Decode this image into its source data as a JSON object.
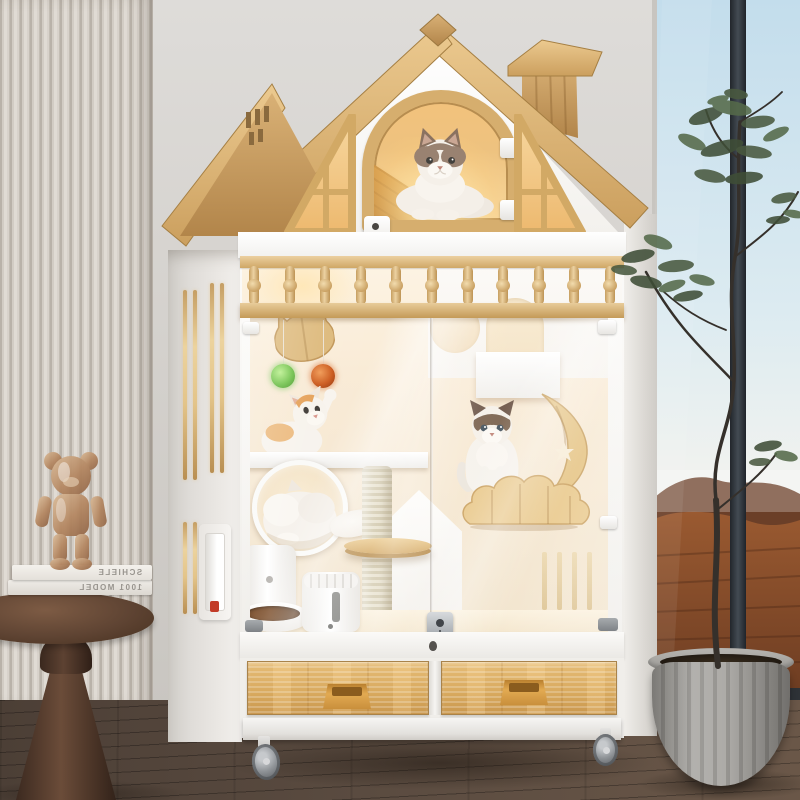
{
  "meta": {
    "type": "product-photo",
    "subject": "Wooden cat villa cage with cats, in a modern living room beside a floor window"
  },
  "decor": {
    "books": [
      {
        "title": "SCHIELE"
      },
      {
        "title": "1001 MODEL"
      }
    ]
  },
  "house": {
    "baluster_count": 11,
    "drawer_count": 2,
    "cat_count": 4,
    "pom_pom_colors": [
      "#5aa832",
      "#b84a16"
    ]
  },
  "palette": {
    "roof_wood": "#d2a868",
    "body_white": "#f7f6f3",
    "wall_gray": "#d5d2ce",
    "slat_wall": "#d7d1c9",
    "floor_wood": "#55473d",
    "window_frame": "#33383d",
    "sky": "#cfe3ee",
    "desert_ground": "#9a5a30",
    "drawer_wood": "#dcb068",
    "sisal_post": "#d9cfb2",
    "planter_gray": "#9d9b97",
    "interior_glow": "#f8e7c9"
  }
}
